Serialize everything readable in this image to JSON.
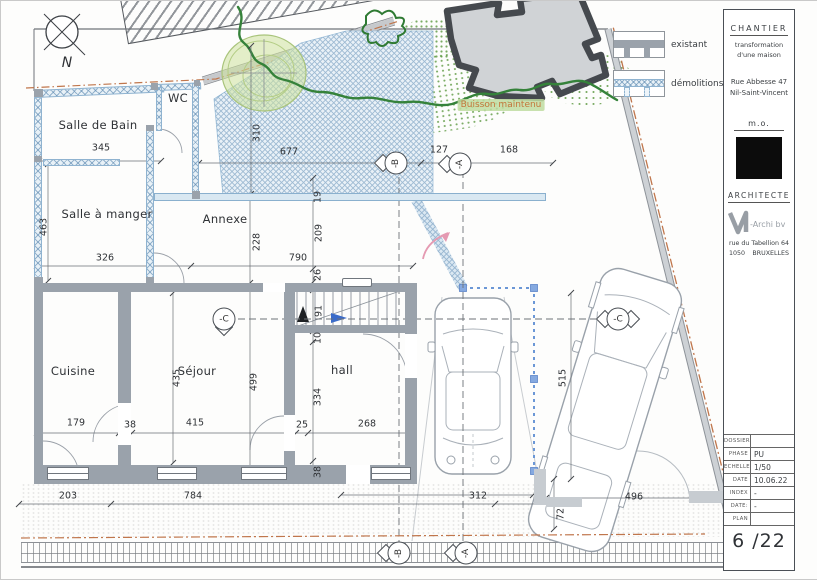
{
  "compass": {
    "north": "N"
  },
  "legend": {
    "existant": "existant",
    "demolitions": "démolitions"
  },
  "rooms": [
    "Salle de Bain",
    "WC",
    "Salle à manger",
    "Annexe",
    "Cuisine",
    "Séjour",
    "hall"
  ],
  "bush_label": "Buisson maintenu",
  "markers": [
    "-B",
    "-A",
    "-C",
    "-C",
    "-B",
    "-A"
  ],
  "dims": [
    "345",
    "310",
    "677",
    "127",
    "168",
    "463",
    "326",
    "790",
    "228",
    "209",
    "19",
    "26",
    "91",
    "10",
    "499",
    "435",
    "334",
    "179",
    "38",
    "415",
    "25",
    "268",
    "38",
    "203",
    "784",
    "312",
    "72",
    "496",
    "515"
  ],
  "title_block": {
    "chantier": "CHANTIER",
    "project_line1": "transformation",
    "project_line2": "d'une maison",
    "address_line1": "Rue Abbesse 47",
    "address_line2": "Nil-Saint-Vincent",
    "mo": "m.o.",
    "architecte": "ARCHITECTE",
    "firm": "-Archi bv",
    "firm_address": "rue du Tabellion 64",
    "firm_postal": "1050",
    "firm_city": "BRUXELLES",
    "fields": [
      {
        "label": "DOSSIER",
        "value": ""
      },
      {
        "label": "PHASE",
        "value": "PU"
      },
      {
        "label": "ECHELLE",
        "value": "1/50"
      },
      {
        "label": "DATE",
        "value": "10.06.22"
      },
      {
        "label": "INDEX",
        "value": "-"
      },
      {
        "label": "DATE:",
        "value": "-"
      },
      {
        "label": "PLAN",
        "value": ""
      }
    ],
    "sheet": "6 /22"
  }
}
